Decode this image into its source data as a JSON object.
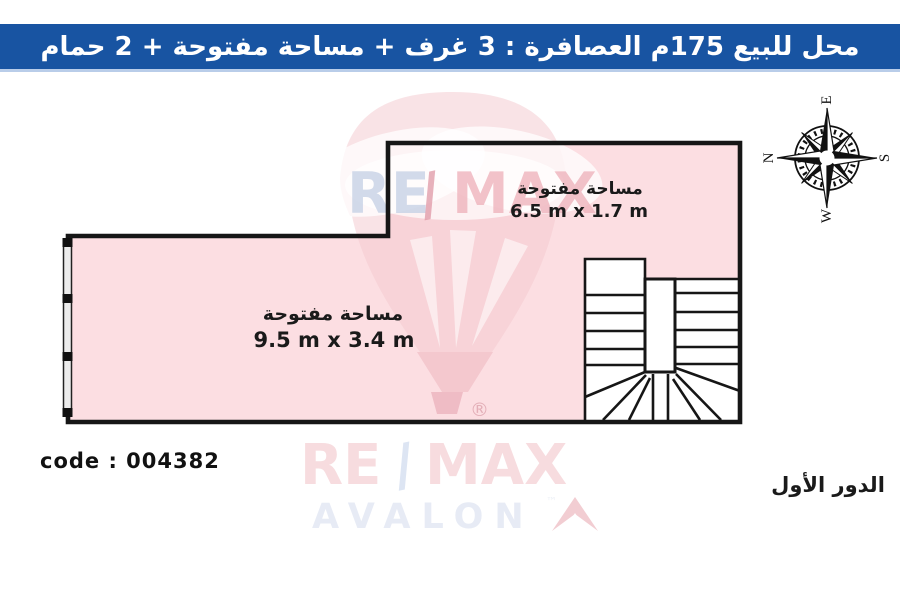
{
  "banner": {
    "title": "محل للبيع 175م العصافرة :  3 غرف + مساحة مفتوحة + 2 حمام"
  },
  "compass": {
    "n": "N",
    "e": "E",
    "s": "S",
    "w": "W"
  },
  "areas": {
    "upper": {
      "label": "مساحة مفتوحة",
      "size": "6.5 m x 1.7 m"
    },
    "main": {
      "label": "مساحة مفتوحة",
      "size": "9.5 m x 3.4 m"
    }
  },
  "footer": {
    "code": "code : 004382",
    "floor": "الدور الأول"
  },
  "watermark": {
    "re": "RE",
    "slash": "/",
    "max": "MAX",
    "avalon": "AVALON",
    "registered": "®",
    "tm": "™"
  },
  "colors": {
    "banner_blue": "#1854a2",
    "room_fill": "#fcdee2",
    "wall": "#161616"
  }
}
